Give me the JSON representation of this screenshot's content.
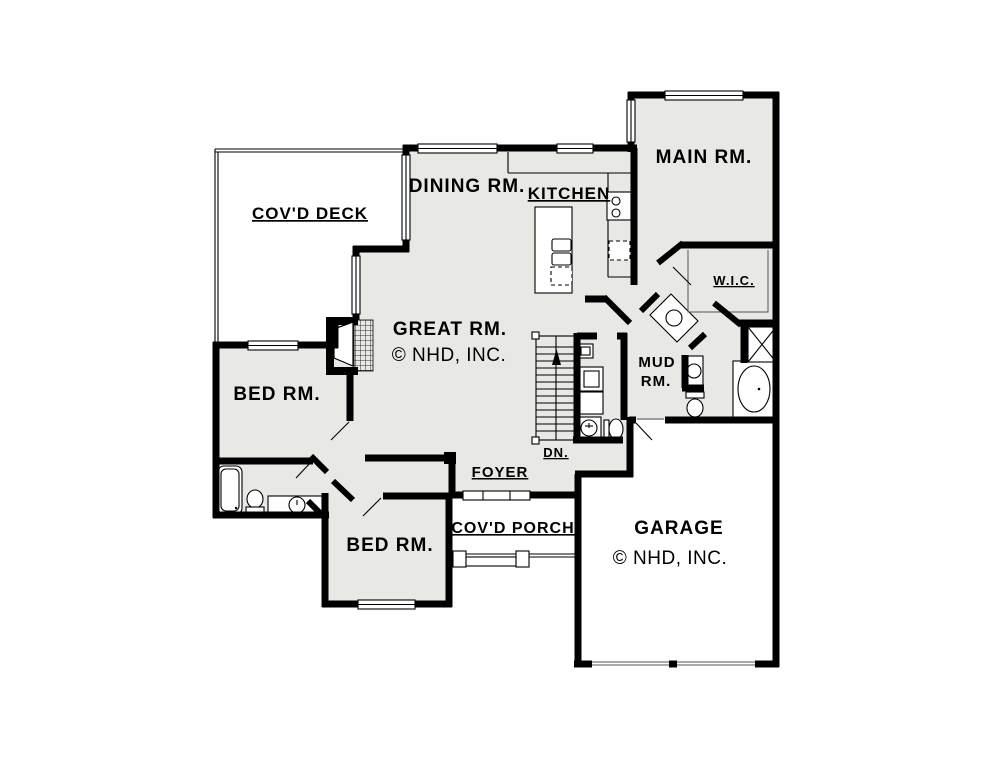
{
  "document": {
    "type": "architectural-first-floor-plan"
  },
  "colors": {
    "wall_black": "#000000",
    "room_fill": "#e8e8e5",
    "paper_white": "#ffffff"
  },
  "rooms": {
    "covd_deck": {
      "label": "COV'D DECK",
      "underlined": true
    },
    "dining_room": {
      "label": "DINING RM.",
      "underlined": false
    },
    "kitchen": {
      "label": "KITCHEN",
      "underlined": true
    },
    "main_room": {
      "label": "MAIN RM.",
      "underlined": false
    },
    "wic": {
      "label": "W.I.C.",
      "underlined": true
    },
    "great_room": {
      "label": "GREAT RM.",
      "underlined": false
    },
    "mud_room": {
      "label_line1": "MUD",
      "label_line2": "RM."
    },
    "bed_room_left": {
      "label": "BED RM.",
      "underlined": false
    },
    "bed_room_lower": {
      "label": "BED RM.",
      "underlined": false
    },
    "foyer": {
      "label": "FOYER",
      "underlined": true
    },
    "stairs": {
      "label": "DN.",
      "underlined": true
    },
    "covd_porch": {
      "label": "COV'D PORCH",
      "underlined": true
    },
    "garage": {
      "label": "GARAGE",
      "underlined": false
    }
  },
  "copyright": {
    "text": "© NHD, INC."
  },
  "fixtures": [
    "kitchen-island-double-sink",
    "kitchen-cooktop",
    "kitchen-counters",
    "dishwasher-dashed",
    "stairs-down",
    "fireplace",
    "shower-x",
    "soaking-tub",
    "bath-tub",
    "toilet",
    "vanity-sink",
    "angled-vanity-sink",
    "water-heater",
    "furnace",
    "porch-posts",
    "garage-doors",
    "entry-door"
  ]
}
